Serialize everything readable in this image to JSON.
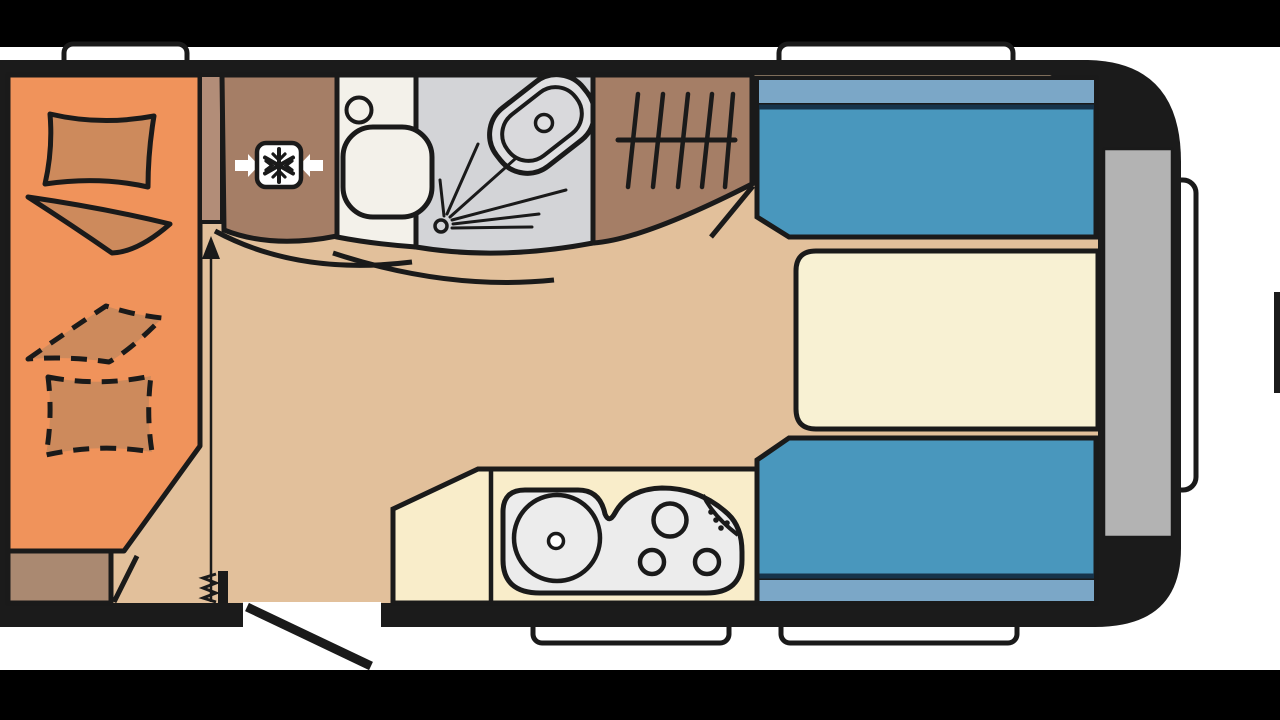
{
  "meta": {
    "description": "Letterboxed video frame showing a caravan / travel-trailer floor plan, no visible text",
    "plan_type": "caravan-floor-plan"
  },
  "colors": {
    "letterbox": "#000000",
    "background": "#ffffff",
    "wall": "#1b1b1b",
    "line": "#1a1a1a",
    "floor": "#e2c09b",
    "bed": "#f0935b",
    "bedding": "#cd8a5c",
    "step": "#aa8971",
    "cabinet": "#a57e66",
    "cabinet_light": "#b28d78",
    "bathroom": "#f3f1ea",
    "shower": "#d3d4d7",
    "fixture": "#ececec",
    "basin_outer": "#dfdfe1",
    "basin_inner": "#d9d9dc",
    "seat": "#4997bd",
    "seat_backrest": "#7ba7c7",
    "seat_divider": "#16334a",
    "table": "#f8f1d3",
    "kitchen": "#f9edca",
    "window": "#ffffff",
    "front_panel": "#b3b3b3",
    "icon_white": "#ffffff"
  },
  "icons": {
    "fridge": "snowflake-in-box-icon",
    "wardrobe": "clothes-hangers-icon",
    "shower": "spray-nozzle-icon",
    "toilet": "toilet-bowl-icon",
    "washbasin": "oval-basin-icon",
    "sink": "round-sink-icon",
    "hob": "three-burner-hob-icon",
    "door": "open-door-swing-icon",
    "walkway": "direction-arrow-icon",
    "bed": "pillow-and-blanket-icon"
  }
}
